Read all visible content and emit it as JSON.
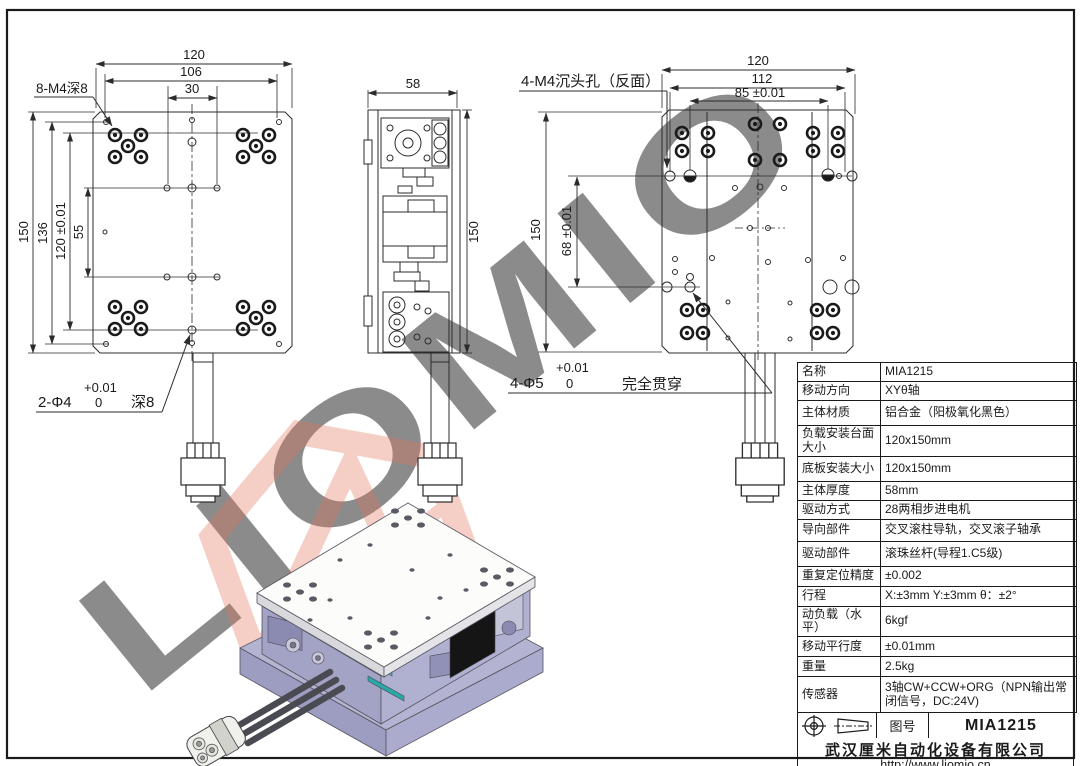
{
  "watermark": {
    "text": "LIOMIO"
  },
  "views": {
    "front": {
      "dim_w": "120",
      "dim_w2": "106",
      "dim_w3": "30",
      "dim_h": "150",
      "dim_h2": "136",
      "dim_h3": "120 ±0.01",
      "dim_h4": "55",
      "note_top": "8-M4深8",
      "note_bot_prefix": "2-Φ4",
      "note_bot_plus": "+0.01",
      "note_bot_zero": "0",
      "note_bot_suffix": "深8"
    },
    "side": {
      "dim_w": "58",
      "dim_h": "150"
    },
    "rear": {
      "dim_w": "120",
      "dim_w2": "112",
      "dim_w3": "85 ±0.01",
      "dim_h": "150",
      "dim_h2": "68 ±0.01",
      "note_top": "4-M4沉头孔（反面）",
      "note_bot_prefix": "4-Φ5",
      "note_bot_plus": "+0.01",
      "note_bot_zero": "0",
      "note_bot_suffix": "完全贯穿"
    }
  },
  "spec_table": {
    "rows": [
      {
        "label": "名称",
        "value": "MIA1215"
      },
      {
        "label": "移动方向",
        "value": "XYθ轴"
      },
      {
        "label": "主体材质",
        "value": "铝合金（阳极氧化黑色）"
      },
      {
        "label": "负载安装台面大小",
        "value": "120x150mm"
      },
      {
        "label": "底板安装大小",
        "value": "120x150mm"
      },
      {
        "label": "主体厚度",
        "value": "58mm"
      },
      {
        "label": "驱动方式",
        "value": "28两相步进电机"
      },
      {
        "label": "导向部件",
        "value": "交叉滚柱导轨，交叉滚子轴承"
      },
      {
        "label": "驱动部件",
        "value": "滚珠丝杆(导程1.C5级)"
      },
      {
        "label": "重复定位精度",
        "value": "±0.002"
      },
      {
        "label": "行程",
        "value": "X:±3mm Y:±3mm θ：±2°"
      },
      {
        "label": "动负载（水平）",
        "value": "6kgf"
      },
      {
        "label": "移动平行度",
        "value": "±0.01mm"
      },
      {
        "label": "重量",
        "value": "2.5kg"
      },
      {
        "label": "传感器",
        "value": "3轴CW+CCW+ORG（NPN输出常闭信号，DC:24V)"
      }
    ]
  },
  "title_block": {
    "field_label": "图号",
    "drawing_no": "MIA1215",
    "company": "武汉厘米自动化设备有限公司",
    "website": "http://www.liomio.cn"
  },
  "colors": {
    "line": "#2b2b2b",
    "watermark_gray": "#c3c3c3",
    "logo_red": "#e4755a",
    "stage_lavender": "#a6a6c8",
    "stage_teal": "#35c4c4"
  }
}
